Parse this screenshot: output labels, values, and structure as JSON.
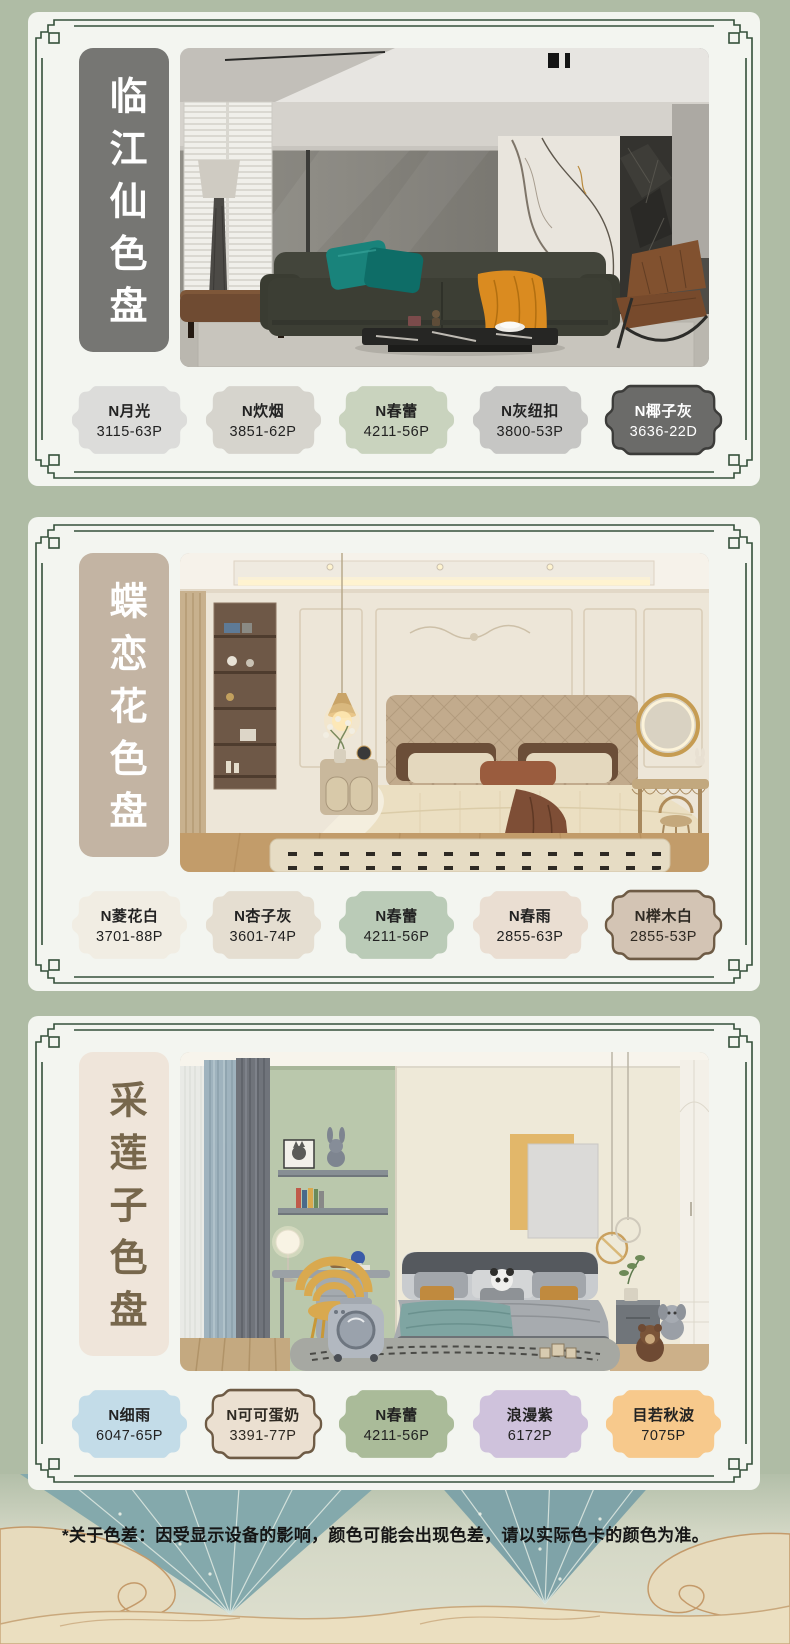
{
  "page": {
    "background": "#AFBCA5",
    "card_background": "#F3F5F0",
    "frame_color": "#35503A"
  },
  "sections": [
    {
      "title": "临江仙色盘",
      "title_bg": "#767673",
      "title_color": "#FFFFFF",
      "photo": "modern-living-room",
      "swatches": [
        {
          "name": "N月光",
          "code": "3115-63P",
          "color": "#DCDCDA",
          "text_color": "#222222"
        },
        {
          "name": "N炊烟",
          "code": "3851-62P",
          "color": "#D6D4CD",
          "text_color": "#222222"
        },
        {
          "name": "N春蕾",
          "code": "4211-56P",
          "color": "#C9D3BE",
          "text_color": "#222222"
        },
        {
          "name": "N灰纽扣",
          "code": "3800-53P",
          "color": "#C6C6C4",
          "text_color": "#222222"
        },
        {
          "name": "N椰子灰",
          "code": "3636-22D",
          "color": "#6B6B69",
          "text_color": "#FFFFFF",
          "border_color": "#3C3C3A"
        }
      ]
    },
    {
      "title": "蝶恋花色盘",
      "title_bg": "#C3B4A3",
      "title_color": "#FFFFFF",
      "photo": "french-cream-bedroom",
      "swatches": [
        {
          "name": "N菱花白",
          "code": "3701-88P",
          "color": "#F1EDE3",
          "text_color": "#222222"
        },
        {
          "name": "N杏子灰",
          "code": "3601-74P",
          "color": "#E5DED1",
          "text_color": "#222222"
        },
        {
          "name": "N春蕾",
          "code": "4211-56P",
          "color": "#BACBB7",
          "text_color": "#222222"
        },
        {
          "name": "N春雨",
          "code": "2855-63P",
          "color": "#EADED2",
          "text_color": "#222222"
        },
        {
          "name": "N榉木白",
          "code": "2855-53P",
          "color": "#D3C4B4",
          "text_color": "#2E2922",
          "border_color": "#6E5B45"
        }
      ]
    },
    {
      "title": "采莲子色盘",
      "title_bg": "#EFE5DA",
      "title_color": "#77674C",
      "photo": "kids-bedroom",
      "swatches": [
        {
          "name": "N细雨",
          "code": "6047-65P",
          "color": "#C3DCE8",
          "text_color": "#222222"
        },
        {
          "name": "N可可蛋奶",
          "code": "3391-77P",
          "color": "#EBE0D1",
          "text_color": "#2E2922",
          "border_color": "#6E5B45"
        },
        {
          "name": "N春蕾",
          "code": "4211-56P",
          "color": "#AABB99",
          "text_color": "#222222"
        },
        {
          "name": "浪漫紫",
          "code": "6172P",
          "color": "#CFC2DC",
          "text_color": "#222222"
        },
        {
          "name": "目若秋波",
          "code": "7075P",
          "color": "#F7C98C",
          "text_color": "#222222"
        }
      ]
    }
  ],
  "footer": {
    "note": "*关于色差：因受显示设备的影响，颜色可能会出现色差，请以实际色卡的颜色为准。"
  }
}
